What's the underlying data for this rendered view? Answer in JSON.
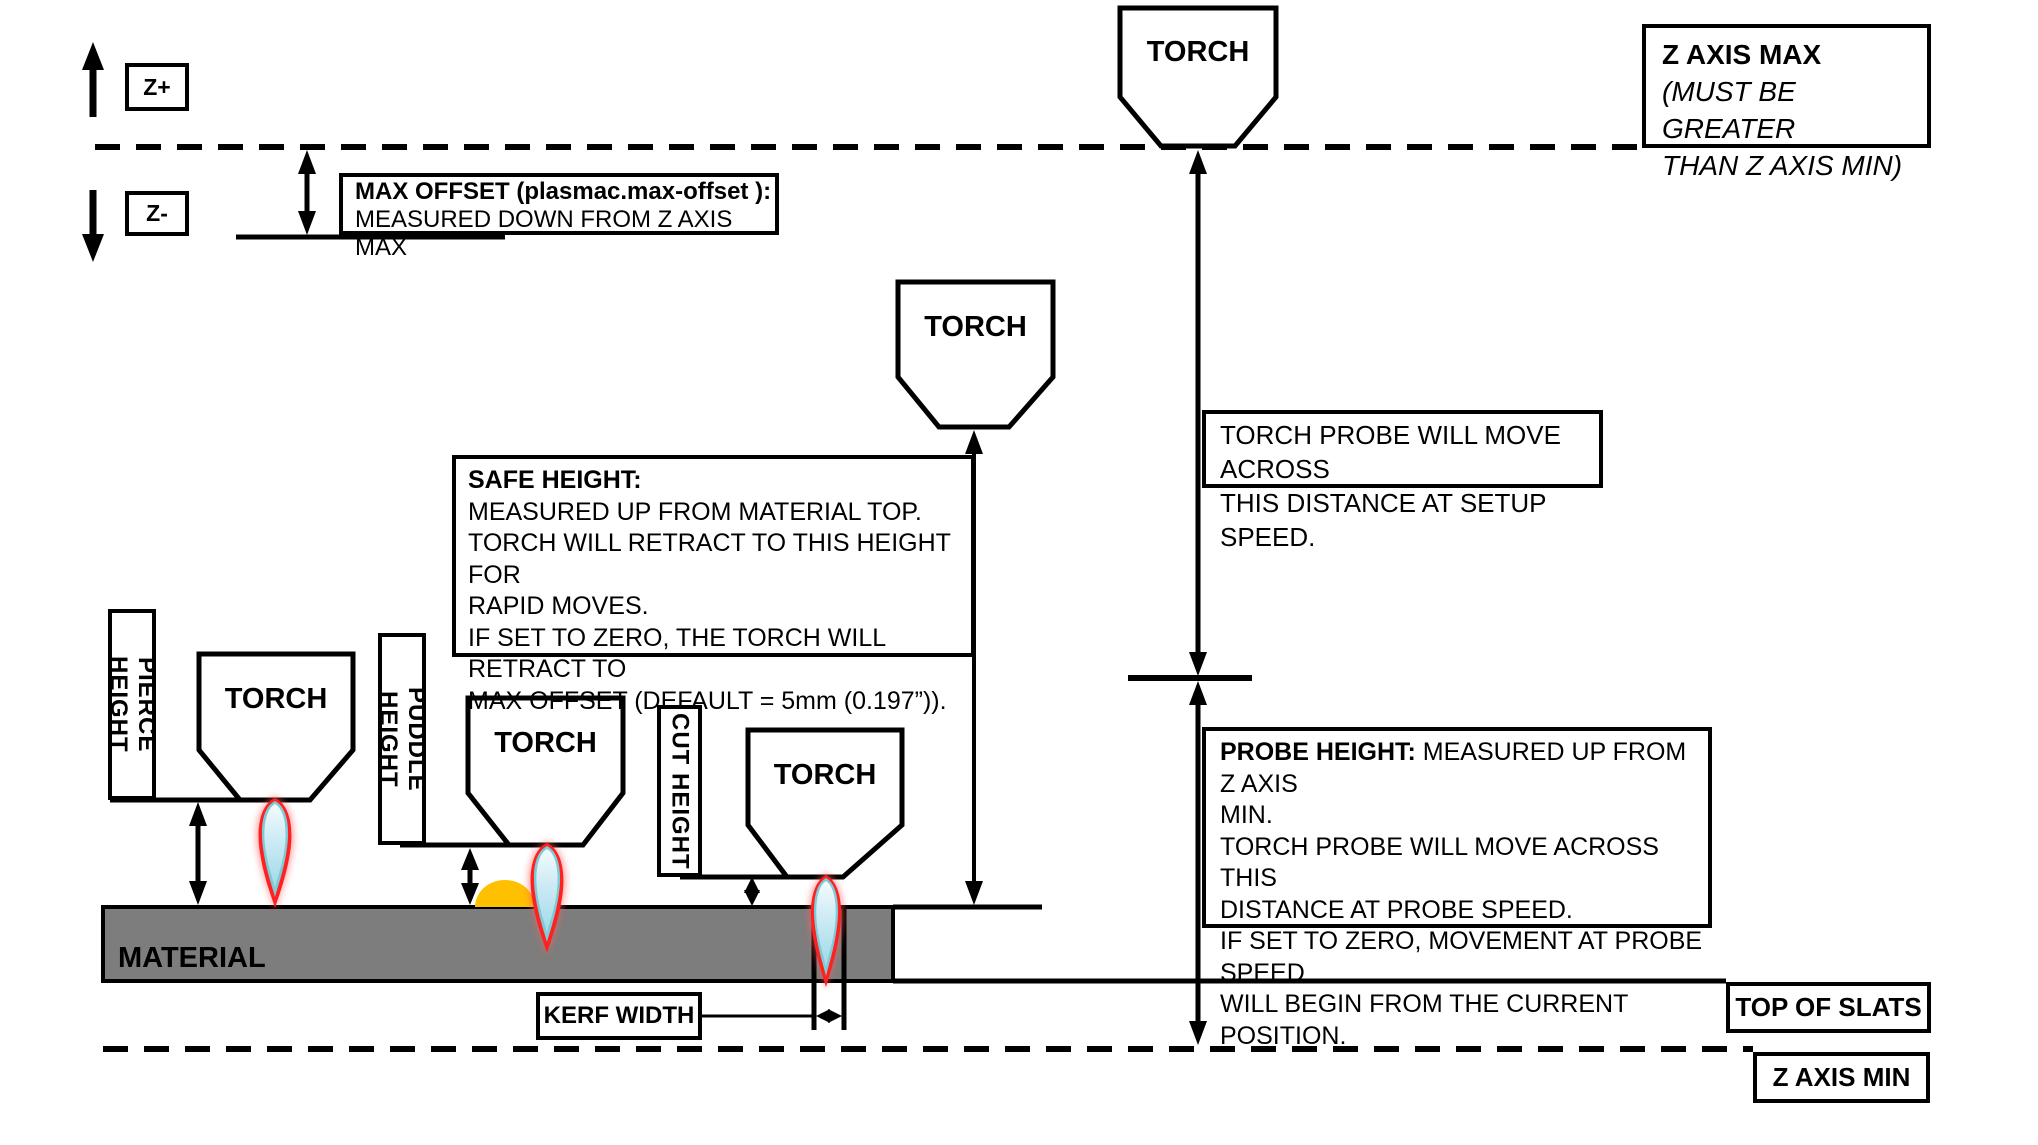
{
  "diagram": {
    "axis": {
      "z_plus": "Z+",
      "z_minus": "Z-"
    },
    "torch_label": "TORCH",
    "max_offset": {
      "line1": "MAX OFFSET (plasmac.max-offset ):",
      "line2": "MEASURED DOWN FROM Z AXIS MAX"
    },
    "z_axis_max": {
      "title": "Z AXIS MAX",
      "note1": "(MUST BE GREATER",
      "note2": "THAN Z AXIS MIN)"
    },
    "torch_probe": {
      "line1": "TORCH PROBE WILL MOVE ACROSS",
      "line2": "THIS DISTANCE AT SETUP SPEED."
    },
    "safe_height": {
      "title": "SAFE HEIGHT:",
      "lines": [
        "MEASURED UP FROM MATERIAL TOP.",
        "TORCH WILL RETRACT TO THIS HEIGHT FOR",
        "RAPID MOVES.",
        "IF SET TO ZERO, THE TORCH WILL RETRACT TO",
        "MAX OFFSET (DEFAULT = 5mm (0.197”))."
      ]
    },
    "probe_height": {
      "title": "PROBE HEIGHT:",
      "title_rest": " MEASURED UP FROM Z AXIS",
      "lines": [
        "MIN.",
        "TORCH PROBE WILL MOVE ACROSS THIS",
        "DISTANCE AT PROBE SPEED.",
        "IF SET TO ZERO,  MOVEMENT AT PROBE SPEED",
        "WILL BEGIN FROM THE CURRENT POSITION."
      ]
    },
    "measure_labels": {
      "pierce": "PIERCE HEIGHT",
      "puddle": "PUDDLE HEIGHT",
      "cut": "CUT HEIGHT"
    },
    "material_label": "MATERIAL",
    "kerf_width": "KERF WIDTH",
    "top_of_slats": "TOP OF SLATS",
    "z_axis_min": "Z AXIS MIN",
    "colors": {
      "material": "#7D7D7D",
      "puddle": "#FFC000",
      "flame_red": "#FF2020",
      "flame_teal": "#7ECBD6",
      "flame_core": "#CBEAF4",
      "line": "#000000"
    }
  }
}
